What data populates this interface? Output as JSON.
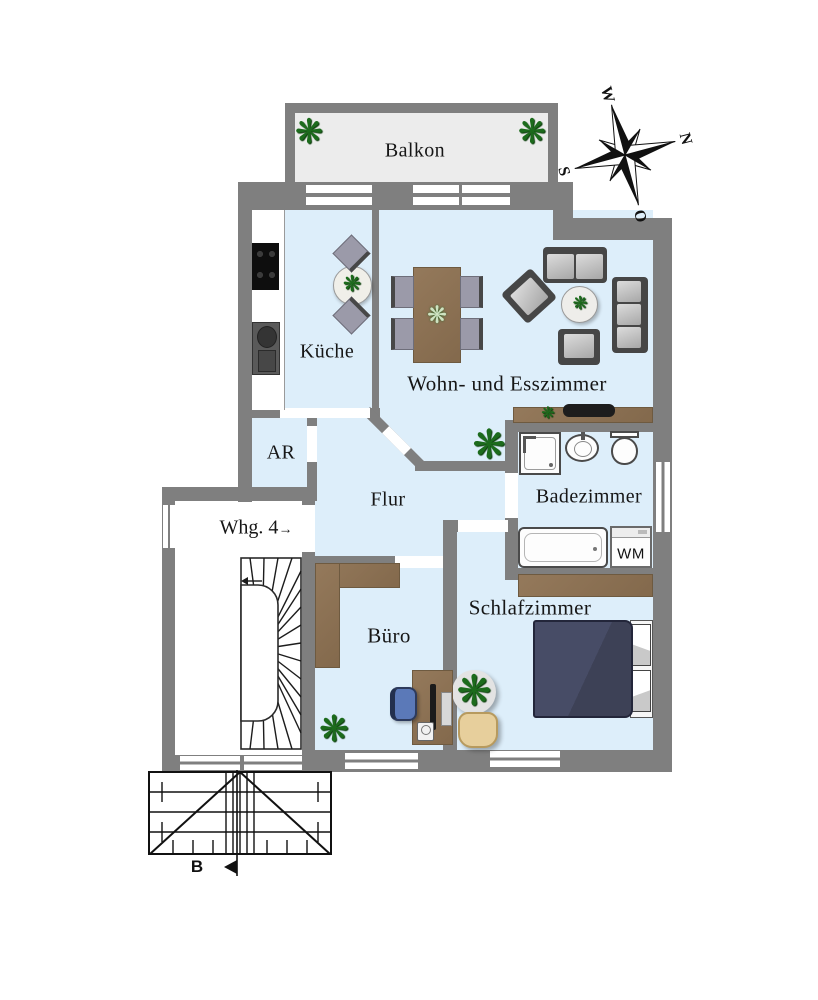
{
  "plan": {
    "rooms": {
      "balkon": {
        "label": "Balkon"
      },
      "kueche": {
        "label": "Küche"
      },
      "wohnzimmer": {
        "label": "Wohn- und Esszimmer"
      },
      "abstellraum": {
        "label": "AR"
      },
      "flur": {
        "label": "Flur"
      },
      "badezimmer": {
        "label": "Badezimmer"
      },
      "buero": {
        "label": "Büro"
      },
      "schlafzimmer": {
        "label": "Schlafzimmer"
      }
    },
    "annotations": {
      "apartment_label": "Whg. 4",
      "apartment_arrow": "→",
      "washing_machine": "WM",
      "section_mark": "B"
    },
    "compass": {
      "n": "N",
      "o": "O",
      "s": "S",
      "w": "W"
    },
    "icons": {
      "plant_glyph": "❋"
    },
    "colors": {
      "wall": "#7f7f7f",
      "room": "#ddeefa",
      "balcony": "#ececec",
      "wood": "#83694c",
      "wood_dark": "#6e5a40",
      "bed": "#3d4156",
      "plant": "#1c6b1c",
      "fabric": "#9b9aa9",
      "office_chair": "#5b79b8",
      "basket": "#e7cf9c"
    }
  }
}
